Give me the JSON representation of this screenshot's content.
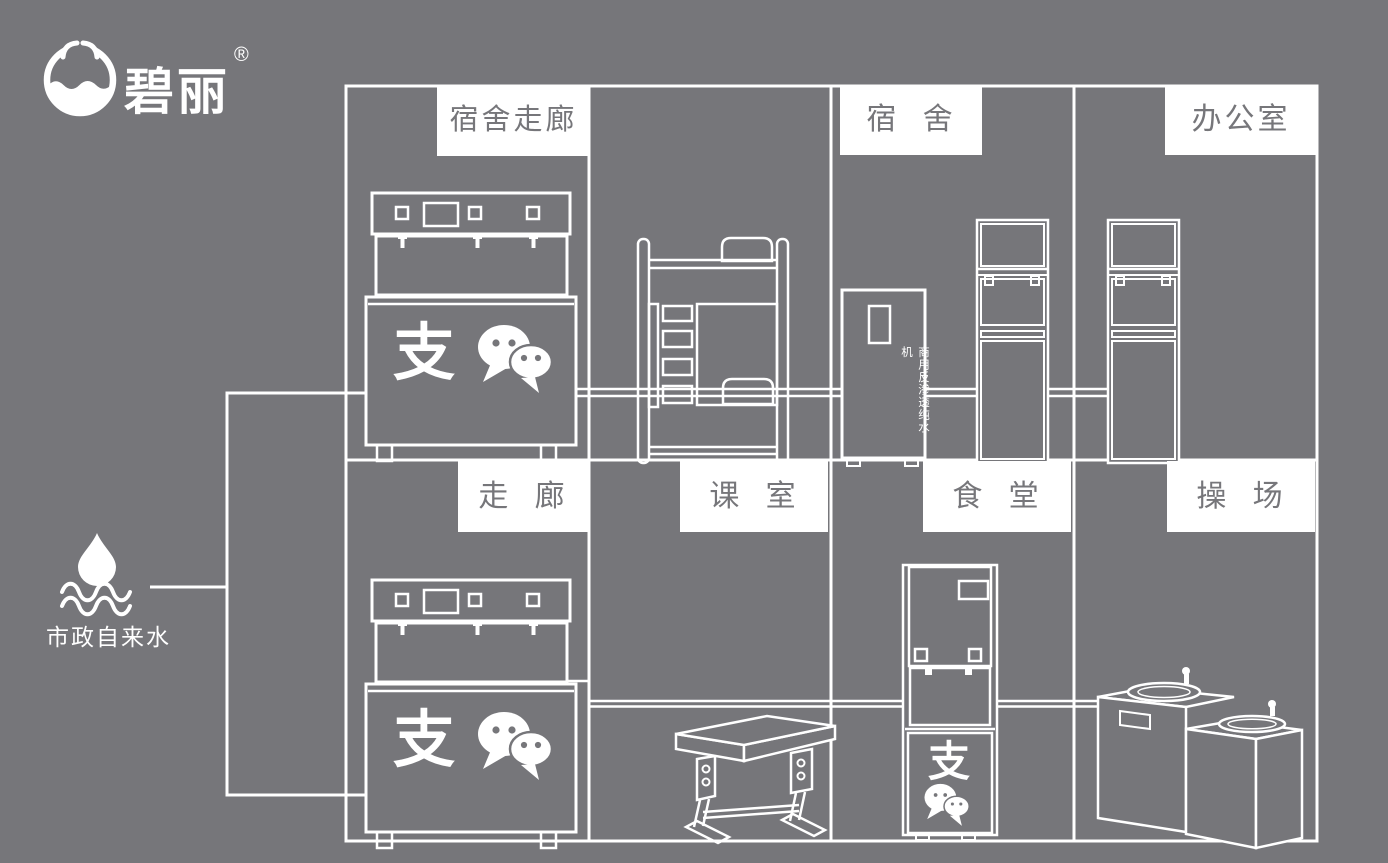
{
  "colors": {
    "background": "#76767a",
    "line": "#ffffff",
    "label_bg": "#ffffff",
    "label_text": "#76767a"
  },
  "logo": {
    "brand": "碧丽",
    "registered": "®"
  },
  "water_source": {
    "label": "市政自来水"
  },
  "rooms": {
    "dorm_corridor": "宿舍走廊",
    "dorm": "宿 舍",
    "office": "办公室",
    "corridor": "走 廊",
    "classroom": "课 室",
    "canteen": "食 堂",
    "playground": "操 场"
  },
  "equipment": {
    "purifier_label": "商用反渗透纯水机",
    "alipay_glyph": "支"
  }
}
